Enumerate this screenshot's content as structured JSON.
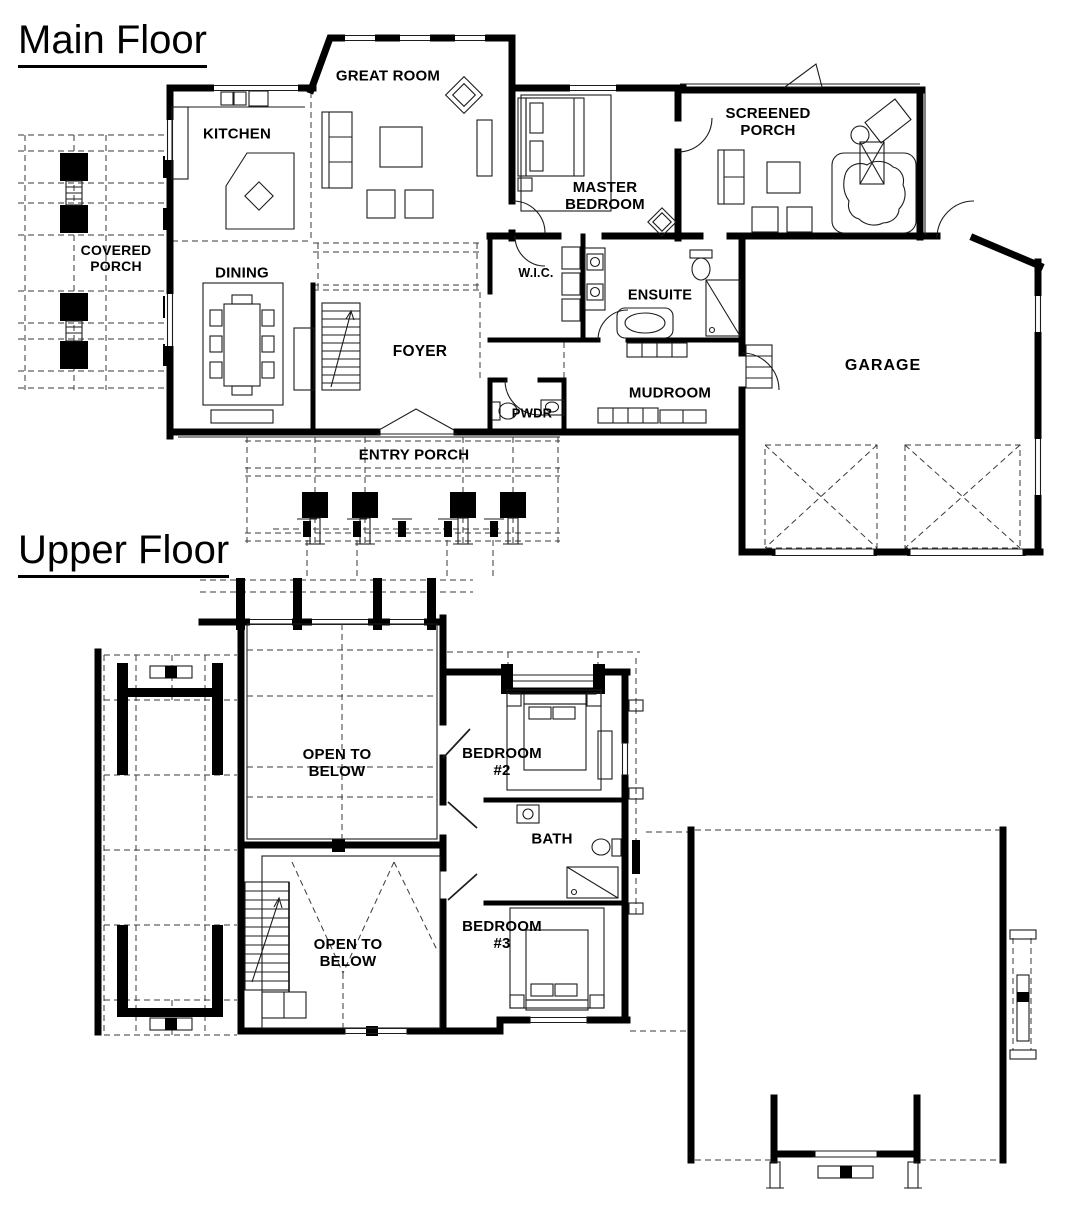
{
  "document": {
    "type": "architectural floor plan",
    "paper_color": "#ffffff",
    "ink_color": "#000000"
  },
  "main_floor": {
    "title": "Main Floor",
    "rooms": {
      "kitchen": "KITCHEN",
      "great_room": "GREAT ROOM",
      "screened_porch": "SCREENED\nPORCH",
      "master_bedroom": "MASTER\nBEDROOM",
      "covered_porch": "COVERED\nPORCH",
      "dining": "DINING",
      "wic": "W.I.C.",
      "ensuite": "ENSUITE",
      "foyer": "FOYER",
      "pwdr": "PWDR",
      "mudroom": "MUDROOM",
      "garage": "GARAGE",
      "entry_porch": "ENTRY PORCH"
    }
  },
  "upper_floor": {
    "title": "Upper Floor",
    "rooms": {
      "open_to_below_front": "OPEN TO\nBELOW",
      "bedroom_2": "BEDROOM\n#2",
      "bath": "BATH",
      "bedroom_3": "BEDROOM\n#3",
      "open_to_below_rear": "OPEN TO\nBELOW"
    }
  }
}
